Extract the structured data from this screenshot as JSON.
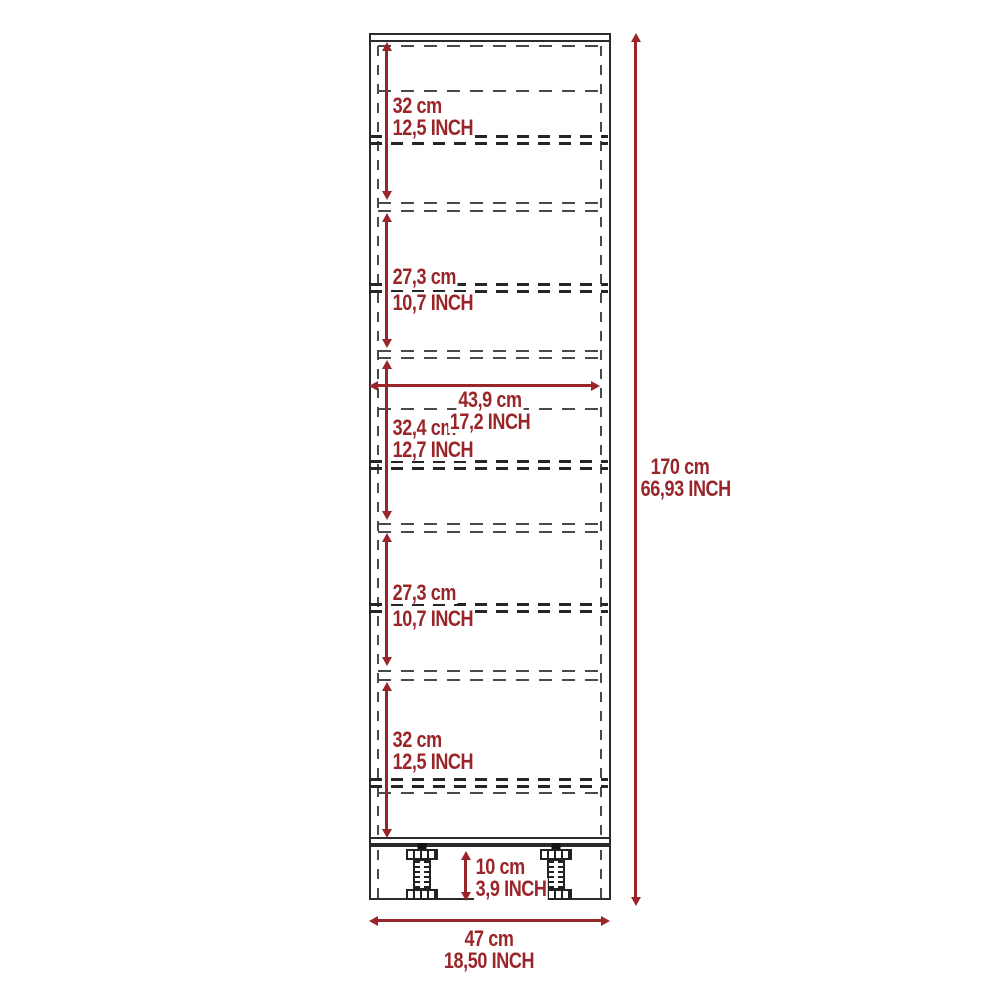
{
  "diagram": {
    "type": "furniture-dimension-drawing",
    "subject": "tall cabinet front elevation with shelf spacing",
    "units": [
      "cm",
      "INCH"
    ],
    "colors": {
      "dimension_red": "#992529",
      "outline_black": "#2b2b2b",
      "hidden_line_gray": "#4a4a4a"
    },
    "sections": [
      {
        "cm": "32 cm",
        "inch": "12,5 INCH"
      },
      {
        "cm": "27,3 cm",
        "inch": "10,7 INCH"
      },
      {
        "cm": "32,4 cm",
        "inch": "12,7 INCH"
      },
      {
        "cm": "27,3 cm",
        "inch": "10,7 INCH"
      },
      {
        "cm": "32 cm",
        "inch": "12,5 INCH"
      }
    ],
    "interior_width": {
      "cm": "43,9 cm",
      "inch": "17,2 INCH"
    },
    "overall_height": {
      "cm": "170 cm",
      "inch": "66,93 INCH"
    },
    "base_height": {
      "cm": "10 cm",
      "inch": "3,9 INCH"
    },
    "overall_width": {
      "cm": "47 cm",
      "inch": "18,50 INCH"
    }
  }
}
